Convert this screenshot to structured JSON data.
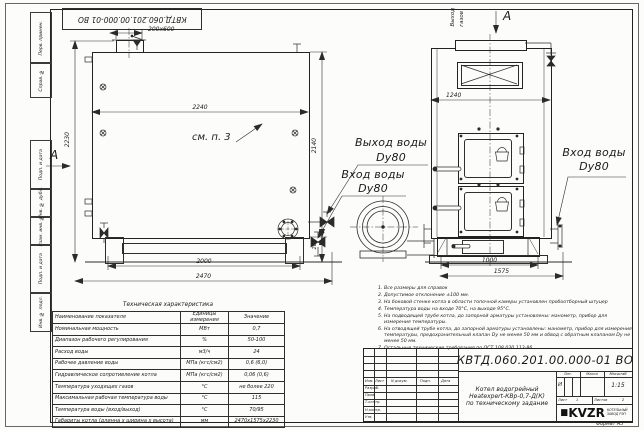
{
  "top_stamp": {
    "code": "КВТД.060.201.00.000-01 ВО"
  },
  "margin": {
    "items": [
      "Перв. примен.",
      "Справ. №",
      "Подп. и дата",
      "Инв. № дубл.",
      "Взам. инв. №",
      "Подп. и дата",
      "Инв. № подл."
    ]
  },
  "labels": {
    "view_arrow": "А",
    "see_note": "см. п. 3",
    "gas_outlet_line1": "Выход",
    "gas_outlet_line2": "газов",
    "water_outlet": "Выход воды",
    "water_inlet": "Вход воды",
    "dy80": "Dy80"
  },
  "dims": {
    "stub": "200x600",
    "body_length": "2240",
    "height_total": "2230",
    "height_body": "2140",
    "base_height": "267",
    "legs_span": "2000",
    "length_total": "2470",
    "front_width": "1240",
    "front_base": "1000",
    "front_total": "1575"
  },
  "notes": {
    "items": [
      "Все размеры для справок",
      "Допустимое отклонение ±100 мм.",
      "На боковой стенке котла в области топочной камеры установлен пробоотборный штуцер",
      "Температура воды на входе 70°С, на выходе 95°С.",
      "На подводящей трубе котла, до запорной арматуры установлены: манометр, прибор для измерения температуры.",
      "На отводящей трубе котла, до запорной арматуры установлены: манометр, прибор для измерения температуры, предохранительный клапан Dу не менее 50 мм и обвод с обратным клапаном Dу не менее 50 мм.",
      "Остальные технические требования по ОСТ 108.030.113-86"
    ]
  },
  "tech_table": {
    "title": "Техническая характеристика",
    "headers": {
      "name": "Наименование показателя",
      "unit": "Единицы измерения",
      "value": "Значение"
    },
    "rows": [
      {
        "name": "Номинальная мощность",
        "unit": "МВт",
        "value": "0,7"
      },
      {
        "name": "Диапазон рабочего регулирования",
        "unit": "%",
        "value": "50-100"
      },
      {
        "name": "Расход воды",
        "unit": "м3/ч",
        "value": "24"
      },
      {
        "name": "Рабочее давление воды",
        "unit": "МПа (кгс/см2)",
        "value": "0,6 (6,0)"
      },
      {
        "name": "Гидравлическое сопротивление котла",
        "unit": "МПа (кгс/см2)",
        "value": "0,06 (0,6)"
      },
      {
        "name": "Температура уходящих газов",
        "unit": "°С",
        "value": "не более 220"
      },
      {
        "name": "Максимальная рабочая температура воды",
        "unit": "°С",
        "value": "115"
      },
      {
        "name": "Температура воды (вход/выход)",
        "unit": "°С",
        "value": "70/95"
      },
      {
        "name": "Габариты котла (длинна х ширина х высота)",
        "unit": "мм",
        "value": "2470х1575х2230"
      }
    ]
  },
  "title_block": {
    "code": "КВТД.060.201.00.000-01 ВО",
    "name_line1": "Котел водогрейный",
    "name_line2": "Heatexpert-КВр-0,7-Д(К)",
    "name_line3": "по техническому задание",
    "col_izm": "Изм.",
    "col_list": "Лист",
    "col_doc": "N докум.",
    "col_sign": "Подп.",
    "col_date": "Дата",
    "row_razrab": "Разраб.",
    "row_prov": "Пров.",
    "row_tkontr": "Т.контр.",
    "row_nkontr": "Н.контр.",
    "row_utv": "Утв.",
    "lit_label": "Лит.",
    "mass_label": "Масса",
    "scale_label": "Масштаб",
    "lit_value": "И",
    "scale_value": "1:15",
    "sheet_label": "Лист",
    "sheet_value": "1",
    "sheets_label": "Листов",
    "sheets_value": "2",
    "logo_text": "KVZR",
    "logo_sub1": "КОТЕЛЬНЫЙ",
    "logo_sub2": "ЗАВОД РЭП",
    "format_note": "Формат А3"
  }
}
